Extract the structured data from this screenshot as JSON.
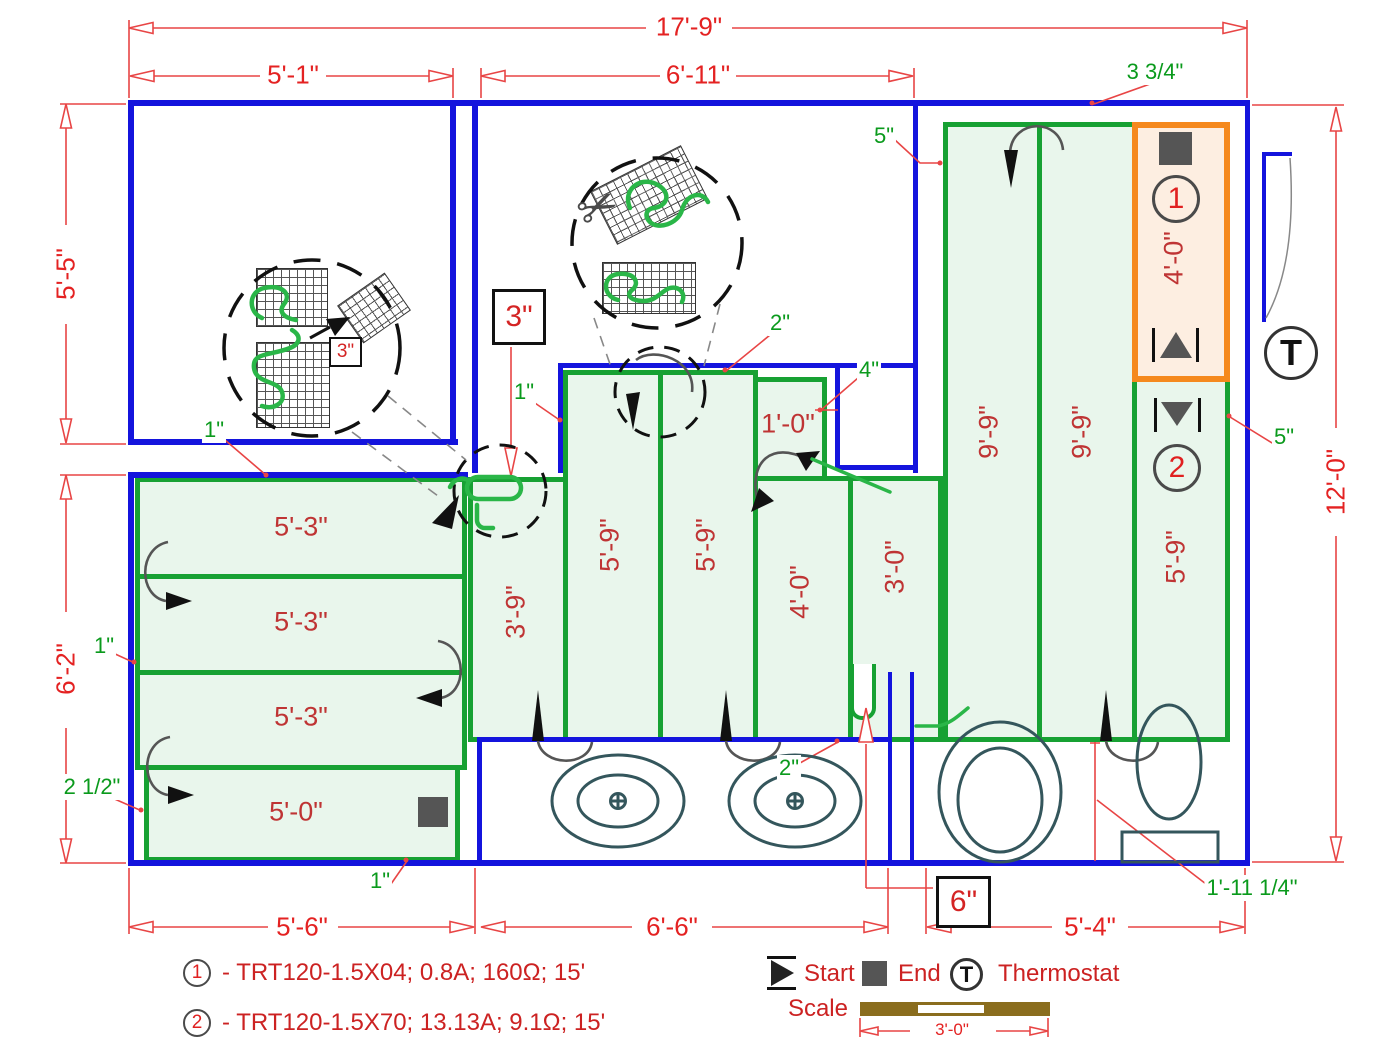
{
  "dimensions": {
    "total_width": "17'-9\"",
    "room1_width": "5'-1\"",
    "room2_width": "6'-11\"",
    "room1_height": "5'-5\"",
    "left_lower_height": "6'-2\"",
    "total_height": "12'-0\"",
    "bottom_left": "5'-6\"",
    "bottom_middle": "6'-6\"",
    "bottom_right": "5'-4\"",
    "scale_length": "3'-0\""
  },
  "mats": {
    "left_rows": [
      "5'-3\"",
      "5'-3\"",
      "5'-3\"",
      "5'-0\""
    ],
    "middle": {
      "col1": "3'-9\"",
      "col2": "5'-9\"",
      "col3": "5'-9\"",
      "small": "1'-0\"",
      "col4": "4'-0\"",
      "col5": "3'-0\""
    },
    "right": {
      "col1": "9'-9\"",
      "col2": "9'-9\"",
      "area1_length": "4'-0\"",
      "area2_length": "5'-9\"",
      "area1_number": "1",
      "area2_number": "2"
    }
  },
  "annotations": {
    "gap_3_34": "3 3/4\"",
    "gap_5_top": "5\"",
    "gap_5_right": "5\"",
    "gap_2_mid": "2\"",
    "gap_4": "4\"",
    "gap_1_room1": "1\"",
    "gap_1_mid": "1\"",
    "gap_1_left": "1\"",
    "gap_1_bottom": "1\"",
    "gap_2_half": "2 1/2\"",
    "gap_2_sink": "2\"",
    "gap_1_11": "1'-11 1/4\"",
    "box_3_room2": "3\"",
    "box_3_detail": "3\"",
    "box_6": "6\""
  },
  "legend": {
    "item1_number": "1",
    "item1_text": "- TRT120-1.5X04; 0.8A; 160Ω; 15'",
    "item2_number": "2",
    "item2_text": "- TRT120-1.5X70; 13.13A; 9.1Ω; 15'",
    "start_label": "Start",
    "end_label": "End",
    "thermostat_label": "Thermostat",
    "thermostat_letter": "T",
    "scale_label": "Scale"
  },
  "icons": {
    "scissors": "✂"
  },
  "colors": {
    "wall": "#1414dd",
    "mat_border": "#17a133",
    "mat_fill": "#e9f6ec",
    "area1_border": "#f5891d",
    "area1_fill": "#fdeee1",
    "dimension_red": "#e42222",
    "annotation_green": "#0a9a1c",
    "scale_brown": "#8a6d1e",
    "fixture": "#34565c"
  }
}
